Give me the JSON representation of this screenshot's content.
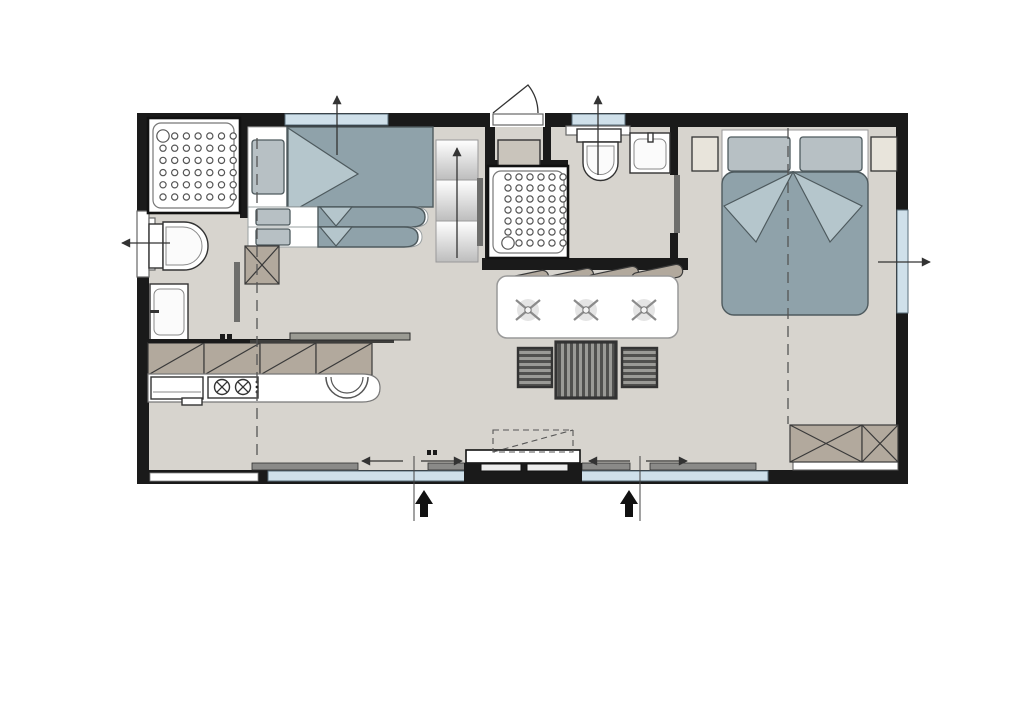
{
  "title": "Mobile home floor plan",
  "canvas": {
    "width": 1024,
    "height": 724
  },
  "colors": {
    "wall": "#1a1a1a",
    "floor": "#d7d4ce",
    "glazing": "#cfe0ea",
    "textile": "#8fa2aa",
    "textile-light": "#b5c6cc",
    "pillow": "#b7c0c4",
    "pillow-line": "#4e5a5e",
    "taupe": "#b2a99d",
    "slider": "#6e6e6c",
    "sash": "#8a8a88",
    "stool": "#9a9a96",
    "stool-stripe": "#50504e",
    "nightstand": "#e8e4db",
    "cabinet": "#c9c4bb"
  },
  "rooms": [
    {
      "name": "bathroom-left",
      "fixtures": [
        "shower",
        "toilet",
        "washbasin"
      ]
    },
    {
      "name": "bunk-bedroom",
      "fixtures": [
        "triple-bunk-bed",
        "steps",
        "crossed-column"
      ]
    },
    {
      "name": "kitchen",
      "fixtures": [
        "wall-cabinets",
        "worktop-bar",
        "hob-2-burners",
        "sink",
        "fridge"
      ]
    },
    {
      "name": "dining",
      "fixtures": [
        "table",
        "bench-cushions",
        "stool",
        "stool",
        "stool"
      ]
    },
    {
      "name": "bathroom-middle",
      "fixtures": [
        "shower",
        "toilet",
        "washbasin",
        "cabinet"
      ]
    },
    {
      "name": "master-bedroom",
      "fixtures": [
        "double-bed",
        "nightstand",
        "nightstand",
        "wardrobe"
      ]
    }
  ],
  "dot_grids": [
    {
      "name": "shower-left-dots",
      "x": 163,
      "y": 136,
      "cols": 7,
      "rows": 6,
      "dx": 11.7,
      "dy": 12.2,
      "r": 3.1,
      "drain": {
        "col": 0,
        "row": 0,
        "r": 6.2
      }
    },
    {
      "name": "shower-middle-dots",
      "x": 508,
      "y": 177,
      "cols": 6,
      "rows": 7,
      "dx": 11,
      "dy": 11,
      "r": 3.1,
      "drain": {
        "col": 0,
        "row": 6,
        "r": 6.2
      }
    }
  ],
  "hatch_cabinets": {
    "x": 148,
    "y": 343,
    "cell_w": 56,
    "cell_h": 32,
    "count": 4
  },
  "crossed_boxes": [
    {
      "x": 245,
      "y": 246,
      "w": 34,
      "h": 38
    },
    {
      "x": 790,
      "y": 425,
      "w": 72,
      "h": 37
    },
    {
      "x": 862,
      "y": 425,
      "w": 36,
      "h": 37
    }
  ],
  "bench_cushions": {
    "w": 52,
    "h": 13,
    "angle": -12,
    "centers": [
      [
        523,
        281
      ],
      [
        568,
        279
      ],
      [
        613,
        277
      ],
      [
        657,
        275
      ]
    ]
  },
  "table_cross_marks": [
    [
      528,
      310
    ],
    [
      586,
      310
    ],
    [
      644,
      310
    ]
  ],
  "vent_arrows": [
    {
      "x1": 337,
      "y1": 155,
      "x2": 337,
      "y2": 96
    },
    {
      "x1": 598,
      "y1": 175,
      "x2": 598,
      "y2": 96
    },
    {
      "x1": 170,
      "y1": 243,
      "x2": 122,
      "y2": 243
    },
    {
      "x1": 878,
      "y1": 262,
      "x2": 930,
      "y2": 262
    },
    {
      "x1": 457,
      "y1": 258,
      "x2": 457,
      "y2": 148
    }
  ],
  "slide_arrows": [
    {
      "x1": 403,
      "y1": 461,
      "x2": 362,
      "y2": 461
    },
    {
      "x1": 421,
      "y1": 461,
      "x2": 462,
      "y2": 461
    },
    {
      "x1": 630,
      "y1": 461,
      "x2": 589,
      "y2": 461
    },
    {
      "x1": 646,
      "y1": 461,
      "x2": 687,
      "y2": 461
    }
  ],
  "entrance_lines": [
    {
      "x": 414,
      "y1": 456,
      "y2": 521
    },
    {
      "x": 640,
      "y1": 456,
      "y2": 521
    }
  ],
  "entrance_arrows": [
    {
      "x": 424,
      "y": 490
    },
    {
      "x": 629,
      "y": 490
    }
  ],
  "section_lines": [
    {
      "x": 257,
      "y1": 138,
      "y2": 456
    },
    {
      "x": 788,
      "y1": 128,
      "y2": 424
    }
  ]
}
